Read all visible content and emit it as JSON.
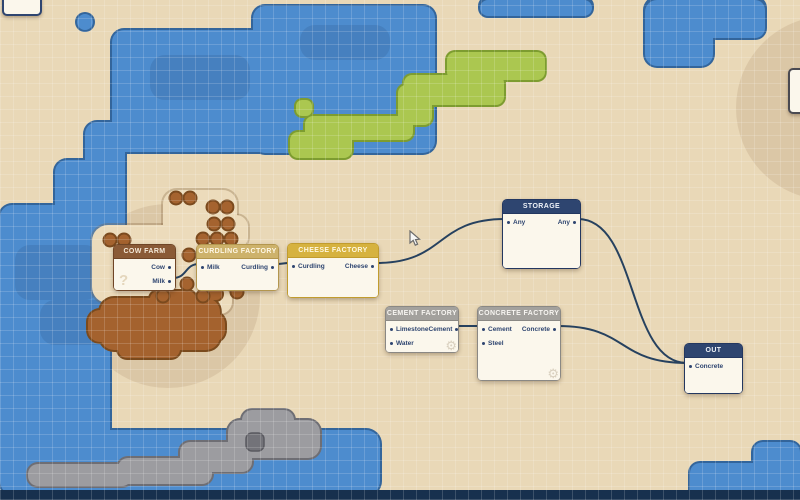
{
  "app": {
    "description": "factory logistics node map"
  },
  "colors": {
    "map": {
      "land": "#e9d8b7",
      "water": "#4d8cce",
      "water_border": "#33659b",
      "grass": "#abc750",
      "grass_border": "#7d9c30",
      "dirt": "#a4622e",
      "dirt_border": "#7a4a1d",
      "stone": "#9c9ca0",
      "stone_border": "#6e6e74",
      "deep_edge": "#17304e",
      "wire": "#26415f",
      "body": "#fbf7ec",
      "body_text": "#2e4570",
      "tick": "#8a4130"
    },
    "schemes": {
      "brown": {
        "header": "#8a5a36",
        "border": "#6f4526",
        "text": "#f6ead9"
      },
      "khaki": {
        "header": "#cdb26b",
        "border": "#b3964e",
        "text": "#fff8e6"
      },
      "gold": {
        "header": "#d6b23f",
        "border": "#c19c2e",
        "text": "#fff8e0"
      },
      "navy": {
        "header": "#2e4570",
        "border": "#233760",
        "text": "#eef2f8"
      },
      "gray": {
        "header": "#a3a19d",
        "border": "#8a8884",
        "text": "#f7f5f1"
      }
    }
  },
  "nodes": [
    {
      "id": "cow-farm",
      "title": "COW FARM",
      "scheme": "brown",
      "x": 113,
      "y": 244,
      "w": 63,
      "h": 47,
      "rows": [
        {
          "out": "Cow"
        },
        {
          "out": "Milk"
        }
      ],
      "watermark": "?"
    },
    {
      "id": "curdling-factory",
      "title": "CURDLING FACTORY",
      "scheme": "khaki",
      "x": 196,
      "y": 244,
      "w": 83,
      "h": 47,
      "rows": [
        {
          "in": "Milk",
          "out": "Curdling"
        }
      ]
    },
    {
      "id": "cheese-factory",
      "title": "CHEESE FACTORY",
      "scheme": "gold",
      "x": 287,
      "y": 243,
      "w": 92,
      "h": 55,
      "rows": [
        {
          "in": "Curdling",
          "out": "Cheese"
        }
      ]
    },
    {
      "id": "storage",
      "title": "STORAGE",
      "scheme": "navy",
      "x": 502,
      "y": 199,
      "w": 79,
      "h": 70,
      "rows": [
        {
          "in": "Any",
          "out": "Any"
        }
      ]
    },
    {
      "id": "cement-factory",
      "title": "CEMENT FACTORY",
      "scheme": "gray",
      "x": 385,
      "y": 306,
      "w": 74,
      "h": 47,
      "rows": [
        {
          "in": "Limestone",
          "out": "Cement"
        },
        {
          "in": "Water"
        }
      ],
      "gear": true
    },
    {
      "id": "concrete-factory",
      "title": "CONCRETE FACTORY",
      "scheme": "gray",
      "x": 477,
      "y": 306,
      "w": 84,
      "h": 75,
      "rows": [
        {
          "in": "Cement",
          "out": "Concrete"
        },
        {
          "in": "Steel"
        }
      ],
      "gear": true
    },
    {
      "id": "out",
      "title": "OUT",
      "scheme": "navy",
      "x": 684,
      "y": 343,
      "w": 59,
      "h": 51,
      "rows": [
        {
          "in": "Concrete"
        }
      ]
    }
  ],
  "connections": [
    {
      "from": [
        "cow-farm",
        1
      ],
      "to": [
        "curdling-factory",
        0
      ]
    },
    {
      "from": [
        "curdling-factory",
        0
      ],
      "to": [
        "cheese-factory",
        0
      ]
    },
    {
      "from": [
        "cheese-factory",
        0
      ],
      "to": [
        "storage",
        0
      ]
    },
    {
      "from": [
        "storage",
        0
      ],
      "to": [
        "out",
        0
      ]
    },
    {
      "from": [
        "cement-factory",
        0
      ],
      "to": [
        "concrete-factory",
        0
      ]
    },
    {
      "from": [
        "concrete-factory",
        0
      ],
      "to": [
        "out",
        0
      ]
    }
  ],
  "tick": {
    "node": "storage",
    "row": 0
  },
  "cursor": {
    "x": 409,
    "y": 230
  }
}
